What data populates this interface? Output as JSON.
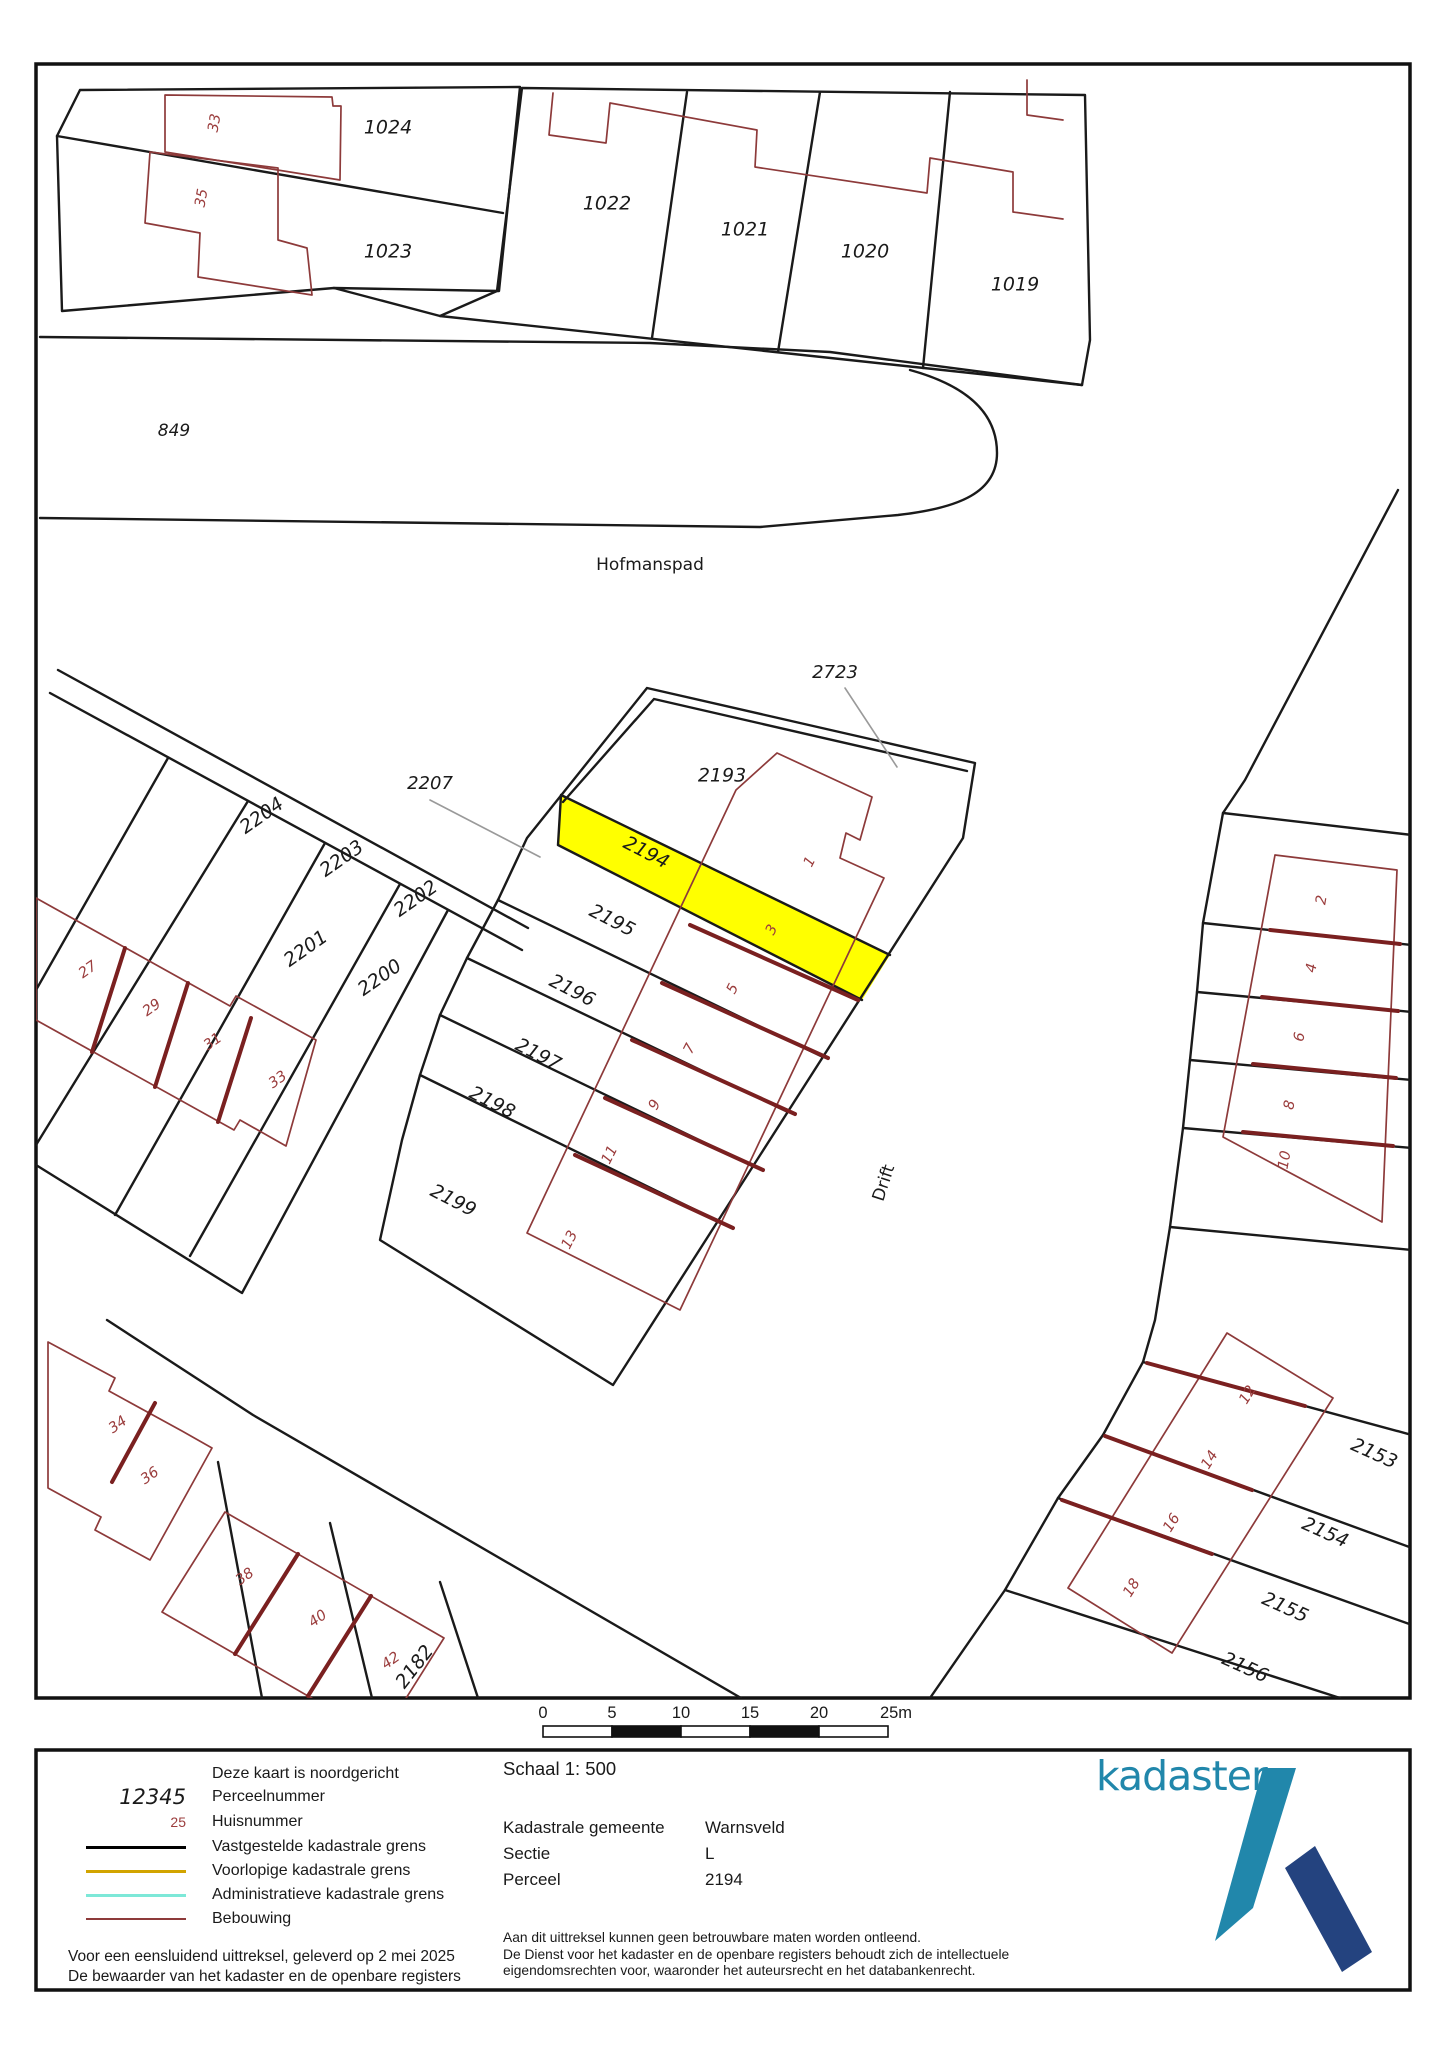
{
  "map": {
    "highlight_parcel": "2194",
    "highlight_color": "#ffff00",
    "boundary_color": "#1a1a1a",
    "building_color": "#8d3a3a",
    "house_number_color": "#9b3d3d",
    "parcel_labels": [
      {
        "t": "1024",
        "x": 388,
        "y": 128
      },
      {
        "t": "1023",
        "x": 388,
        "y": 252
      },
      {
        "t": "1022",
        "x": 607,
        "y": 204
      },
      {
        "t": "1021",
        "x": 745,
        "y": 230
      },
      {
        "t": "1020",
        "x": 865,
        "y": 252
      },
      {
        "t": "1019",
        "x": 1015,
        "y": 285
      },
      {
        "t": "849",
        "x": 174,
        "y": 431,
        "s": 17
      },
      {
        "t": "2723",
        "x": 835,
        "y": 673,
        "s": 18
      },
      {
        "t": "2207",
        "x": 430,
        "y": 784,
        "s": 18
      },
      {
        "t": "2193",
        "x": 722,
        "y": 776
      },
      {
        "t": "2194",
        "x": 646,
        "y": 853,
        "r": 27
      },
      {
        "t": "2195",
        "x": 612,
        "y": 921,
        "r": 27
      },
      {
        "t": "2196",
        "x": 572,
        "y": 991,
        "r": 27
      },
      {
        "t": "2197",
        "x": 538,
        "y": 1055,
        "r": 27
      },
      {
        "t": "2198",
        "x": 492,
        "y": 1103,
        "r": 27
      },
      {
        "t": "2199",
        "x": 453,
        "y": 1201,
        "r": 27
      },
      {
        "t": "2204",
        "x": 262,
        "y": 816,
        "r": -35
      },
      {
        "t": "2203",
        "x": 342,
        "y": 859,
        "r": -35
      },
      {
        "t": "2202",
        "x": 416,
        "y": 899,
        "r": -35
      },
      {
        "t": "2201",
        "x": 306,
        "y": 949,
        "r": -35
      },
      {
        "t": "2200",
        "x": 380,
        "y": 978,
        "r": -35
      },
      {
        "t": "2153",
        "x": 1374,
        "y": 1454,
        "r": 24
      },
      {
        "t": "2154",
        "x": 1325,
        "y": 1533,
        "r": 24
      },
      {
        "t": "2155",
        "x": 1285,
        "y": 1608,
        "r": 24
      },
      {
        "t": "2156",
        "x": 1245,
        "y": 1668,
        "r": 24
      },
      {
        "t": "2182",
        "x": 415,
        "y": 1667,
        "r": -52
      }
    ],
    "house_labels": [
      {
        "t": "33",
        "x": 215,
        "y": 123,
        "r": -80
      },
      {
        "t": "35",
        "x": 202,
        "y": 198,
        "r": -80
      },
      {
        "t": "1",
        "x": 810,
        "y": 862,
        "r": -63
      },
      {
        "t": "3",
        "x": 772,
        "y": 930,
        "r": -63
      },
      {
        "t": "5",
        "x": 733,
        "y": 989,
        "r": -63
      },
      {
        "t": "7",
        "x": 690,
        "y": 1049,
        "r": -63
      },
      {
        "t": "9",
        "x": 655,
        "y": 1105,
        "r": -63
      },
      {
        "t": "11",
        "x": 610,
        "y": 1155,
        "r": -63
      },
      {
        "t": "13",
        "x": 570,
        "y": 1240,
        "r": -63
      },
      {
        "t": "27",
        "x": 88,
        "y": 970,
        "r": -35
      },
      {
        "t": "29",
        "x": 152,
        "y": 1008,
        "r": -35
      },
      {
        "t": "31",
        "x": 213,
        "y": 1042,
        "r": -35
      },
      {
        "t": "33",
        "x": 278,
        "y": 1080,
        "r": -35
      },
      {
        "t": "2",
        "x": 1322,
        "y": 900,
        "r": -80
      },
      {
        "t": "4",
        "x": 1312,
        "y": 968,
        "r": -80
      },
      {
        "t": "6",
        "x": 1300,
        "y": 1037,
        "r": -80
      },
      {
        "t": "8",
        "x": 1290,
        "y": 1105,
        "r": -80
      },
      {
        "t": "10",
        "x": 1285,
        "y": 1160,
        "r": -80
      },
      {
        "t": "12",
        "x": 1248,
        "y": 1395,
        "r": -58
      },
      {
        "t": "14",
        "x": 1210,
        "y": 1460,
        "r": -58
      },
      {
        "t": "16",
        "x": 1172,
        "y": 1523,
        "r": -58
      },
      {
        "t": "18",
        "x": 1132,
        "y": 1588,
        "r": -58
      },
      {
        "t": "34",
        "x": 118,
        "y": 1425,
        "r": -35
      },
      {
        "t": "36",
        "x": 150,
        "y": 1476,
        "r": -35
      },
      {
        "t": "38",
        "x": 245,
        "y": 1577,
        "r": -35
      },
      {
        "t": "40",
        "x": 318,
        "y": 1619,
        "r": -35
      },
      {
        "t": "42",
        "x": 391,
        "y": 1661,
        "r": -35
      }
    ],
    "street_labels": [
      {
        "t": "Hofmanspad",
        "x": 650,
        "y": 565
      },
      {
        "t": "Drift",
        "x": 884,
        "y": 1183,
        "r": -72
      }
    ]
  },
  "scalebar": {
    "ticks": [
      "0",
      "5",
      "10",
      "15",
      "20",
      "25m"
    ]
  },
  "legend": {
    "rows": [
      {
        "type": "plain",
        "sample": "",
        "label": "Deze kaart is noordgericht"
      },
      {
        "type": "italic",
        "sample": "12345",
        "label": "Perceelnummer"
      },
      {
        "type": "red",
        "sample": "25",
        "label": "Huisnummer"
      },
      {
        "type": "line",
        "color": "#000000",
        "width": 3,
        "label": "Vastgestelde kadastrale grens"
      },
      {
        "type": "line",
        "color": "#d2a400",
        "width": 3,
        "label": "Voorlopige kadastrale grens"
      },
      {
        "type": "line",
        "color": "#7de8d8",
        "width": 3,
        "label": "Administratieve kadastrale grens"
      },
      {
        "type": "line",
        "color": "#8d3a3a",
        "width": 2,
        "label": "Bebouwing"
      }
    ],
    "delivery_lines": [
      "Voor een eensluidend uittreksel, geleverd op 2 mei 2025",
      "De bewaarder van het kadaster en de openbare registers"
    ]
  },
  "info": {
    "scale_label": "Schaal 1: 500",
    "rows": [
      {
        "label": "Kadastrale gemeente",
        "value": "Warnsveld"
      },
      {
        "label": "Sectie",
        "value": "L"
      },
      {
        "label": "Perceel",
        "value": "2194"
      }
    ],
    "disclaimer_lines": [
      "Aan dit uittreksel kunnen geen betrouwbare maten worden ontleend.",
      "De Dienst voor het kadaster en de openbare registers behoudt zich de intellectuele",
      "eigendomsrechten voor, waaronder het auteursrecht en het databankenrecht."
    ]
  },
  "logo": {
    "wordmark": "kadaster",
    "teal": "#2187ab",
    "navy": "#24437f"
  }
}
